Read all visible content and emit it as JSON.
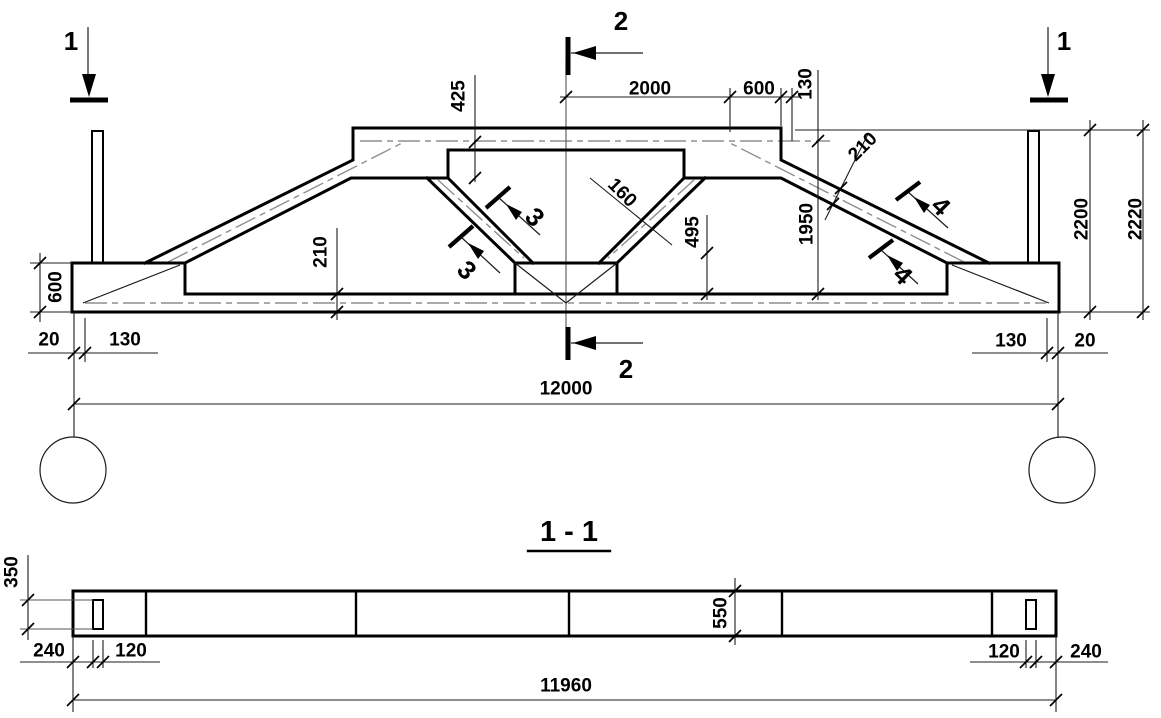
{
  "elevation": {
    "section_marks": {
      "one": "1",
      "two": "2",
      "three": "3",
      "four": "4"
    },
    "dims": {
      "half_top_flat": "2000",
      "top_slope_proj": "600",
      "top_step": "130",
      "top_chord_offset": "425",
      "diagonal_thickness": "160",
      "mid_vertical": "495",
      "top_chord_thickness": "210",
      "bottom_chord_thickness": "210",
      "slope_height": "1950",
      "height_inner": "2200",
      "height_outer": "2220",
      "end_height": "600",
      "left_edge_offset": "20",
      "left_bearing": "130",
      "right_bearing": "130",
      "right_edge_offset": "20",
      "span": "12000"
    }
  },
  "section_1_1": {
    "title": "1 - 1",
    "dims": {
      "flange_height": "350",
      "edge_to_hole_left": "240",
      "hole_width_left": "120",
      "depth": "550",
      "hole_width_right": "120",
      "edge_to_hole_right": "240",
      "length": "11960"
    }
  }
}
